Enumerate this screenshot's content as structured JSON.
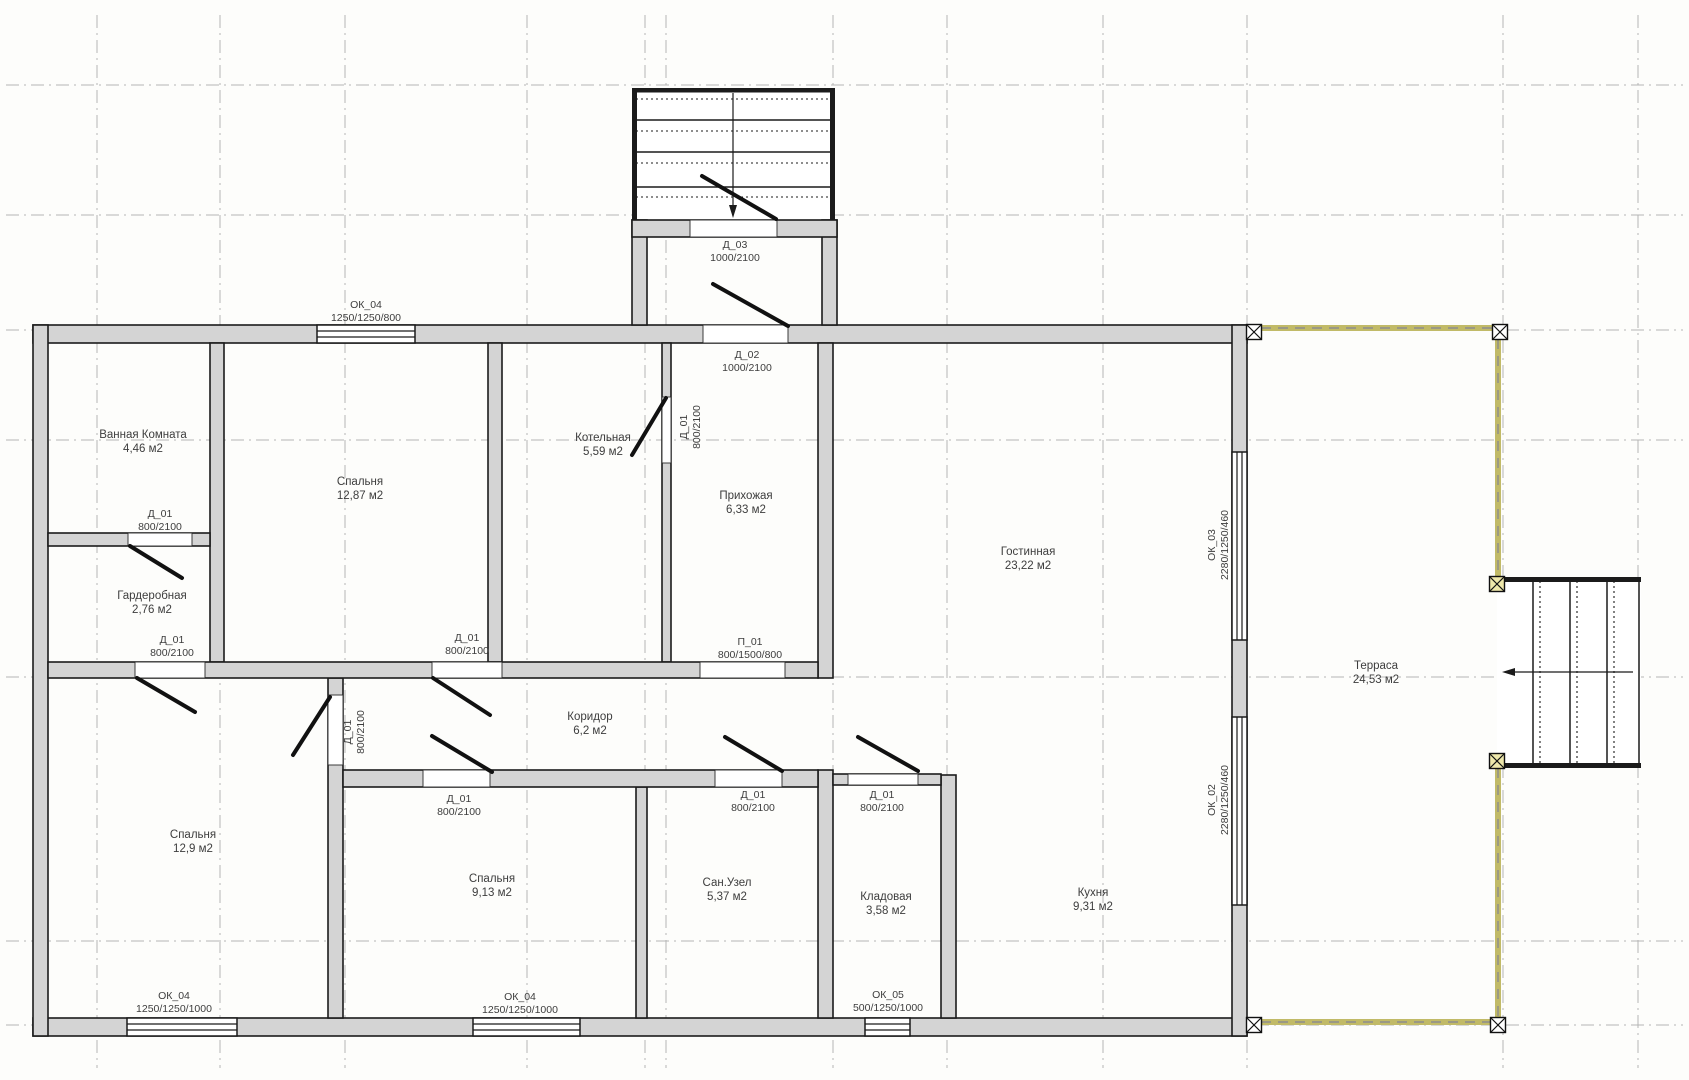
{
  "document": {
    "type": "architectural-floor-plan",
    "units_note": "м2"
  },
  "canvas": {
    "width": 1689,
    "height": 1080,
    "background": "#fdfdfb"
  },
  "colors": {
    "wall_fill": "#d4d4d4",
    "wall_stroke": "#1b1b1b",
    "grid_line": "#b5b5b5",
    "terrace_edge": "#c1ba67",
    "terrace_dash": "#8d8d8d",
    "stair_line": "#1b1b1b",
    "door_leaf": "#111111",
    "label_text": "#3d3d3d",
    "post_fill_corner": "#ffffff",
    "post_fill_stair": "#eee8ab"
  },
  "grid": {
    "vertical_x": [
      97,
      220,
      345,
      527,
      645,
      666,
      833,
      947,
      1103,
      1247,
      1503,
      1638
    ],
    "horizontal_y": [
      85,
      215,
      330,
      440,
      677,
      941,
      1025
    ],
    "x_extent": [
      6,
      1683
    ],
    "y_extent": [
      15,
      1068
    ]
  },
  "walls": [
    [
      33,
      325,
      1214,
      18
    ],
    [
      33,
      1018,
      1214,
      18
    ],
    [
      33,
      325,
      15,
      711
    ],
    [
      1232,
      325,
      15,
      711
    ],
    [
      210,
      343,
      14,
      319
    ],
    [
      488,
      343,
      14,
      319
    ],
    [
      662,
      343,
      9,
      319
    ],
    [
      818,
      343,
      15,
      335
    ],
    [
      328,
      678,
      15,
      340
    ],
    [
      636,
      787,
      11,
      231
    ],
    [
      818,
      770,
      15,
      248
    ],
    [
      941,
      775,
      15,
      243
    ],
    [
      48,
      533,
      162,
      13
    ],
    [
      48,
      662,
      770,
      16
    ],
    [
      343,
      770,
      475,
      17
    ],
    [
      833,
      774,
      108,
      11
    ],
    [
      632,
      220,
      15,
      105
    ],
    [
      822,
      220,
      15,
      105
    ],
    [
      632,
      220,
      205,
      17
    ]
  ],
  "openings": [
    [
      128,
      533,
      64,
      13
    ],
    [
      135,
      662,
      70,
      16
    ],
    [
      432,
      662,
      70,
      16
    ],
    [
      700,
      662,
      85,
      16
    ],
    [
      690,
      220,
      87,
      17
    ],
    [
      703,
      325,
      85,
      18
    ],
    [
      662,
      397,
      9,
      66
    ],
    [
      328,
      695,
      15,
      70
    ],
    [
      423,
      770,
      67,
      17
    ],
    [
      715,
      770,
      67,
      17
    ],
    [
      848,
      774,
      70,
      11
    ]
  ],
  "windows": [
    {
      "x": 317,
      "y": 325,
      "w": 98,
      "h": 18,
      "dir": "h"
    },
    {
      "x": 127,
      "y": 1018,
      "w": 110,
      "h": 18,
      "dir": "h"
    },
    {
      "x": 473,
      "y": 1018,
      "w": 107,
      "h": 18,
      "dir": "h"
    },
    {
      "x": 865,
      "y": 1018,
      "w": 45,
      "h": 18,
      "dir": "h"
    },
    {
      "x": 1232,
      "y": 452,
      "w": 15,
      "h": 188,
      "dir": "v"
    },
    {
      "x": 1232,
      "y": 717,
      "w": 15,
      "h": 188,
      "dir": "v"
    }
  ],
  "door_leaves": [
    [
      130,
      546,
      182,
      578
    ],
    [
      137,
      678,
      195,
      712
    ],
    [
      433,
      678,
      490,
      715
    ],
    [
      666,
      398,
      632,
      455
    ],
    [
      330,
      697,
      293,
      755
    ],
    [
      432,
      736,
      492,
      772
    ],
    [
      725,
      737,
      782,
      771
    ],
    [
      858,
      737,
      918,
      771
    ],
    [
      713,
      284,
      788,
      326
    ],
    [
      702,
      176,
      776,
      219
    ]
  ],
  "terrace": {
    "segments": [
      [
        1261,
        328,
        1493,
        328
      ],
      [
        1261,
        1022,
        1491,
        1022
      ],
      [
        1498,
        339,
        1498,
        577
      ],
      [
        1498,
        768,
        1498,
        1017
      ]
    ],
    "posts": [
      {
        "x": 1254,
        "y": 332,
        "fill": "#ffffff"
      },
      {
        "x": 1500,
        "y": 332,
        "fill": "#ffffff"
      },
      {
        "x": 1254,
        "y": 1025,
        "fill": "#ffffff"
      },
      {
        "x": 1498,
        "y": 1025,
        "fill": "#ffffff"
      },
      {
        "x": 1497,
        "y": 584,
        "fill": "#eee8ab"
      },
      {
        "x": 1497,
        "y": 761,
        "fill": "#eee8ab"
      }
    ]
  },
  "porch_stairs": {
    "x": 632,
    "y": 88,
    "w": 203,
    "h": 132,
    "solid_lines_y": [
      120,
      152,
      187
    ],
    "dotted_lines_y": [
      99,
      131,
      163,
      197
    ],
    "center_x": 733,
    "arrow_tip_y": 218
  },
  "side_stairs": {
    "x": 1497,
    "y": 577,
    "w": 144,
    "h": 191,
    "solid_lines_x": [
      1533,
      1570,
      1607
    ],
    "dotted_lines_x": [
      1540,
      1577,
      1614
    ],
    "arrow_y": 672,
    "arrow_from_x": 1633,
    "arrow_tip_x": 1502
  },
  "room_labels": [
    {
      "name": "Ванная Комната",
      "area": "4,46 м2",
      "x": 143,
      "y": 441
    },
    {
      "name": "Гардеробная",
      "area": "2,76 м2",
      "x": 152,
      "y": 602
    },
    {
      "name": "Спальня",
      "area": "12,87 м2",
      "x": 360,
      "y": 488
    },
    {
      "name": "Котельная",
      "area": "5,59 м2",
      "x": 603,
      "y": 444
    },
    {
      "name": "Прихожая",
      "area": "6,33 м2",
      "x": 746,
      "y": 502
    },
    {
      "name": "Гостинная",
      "area": "23,22 м2",
      "x": 1028,
      "y": 558
    },
    {
      "name": "Спальня",
      "area": "12,9 м2",
      "x": 193,
      "y": 841
    },
    {
      "name": "Коридор",
      "area": "6,2 м2",
      "x": 590,
      "y": 723
    },
    {
      "name": "Спальня",
      "area": "9,13 м2",
      "x": 492,
      "y": 885
    },
    {
      "name": "Сан.Узел",
      "area": "5,37 м2",
      "x": 727,
      "y": 889
    },
    {
      "name": "Кладовая",
      "area": "3,58 м2",
      "x": 886,
      "y": 903
    },
    {
      "name": "Кухня",
      "area": "9,31 м2",
      "x": 1093,
      "y": 899
    },
    {
      "name": "Терраса",
      "area": "24,53 м2",
      "x": 1376,
      "y": 672
    }
  ],
  "tag_labels": [
    {
      "code": "ОК_04",
      "size": "1250/1250/800",
      "x": 366,
      "y": 311,
      "rot": 0
    },
    {
      "code": "Д_03",
      "size": "1000/2100",
      "x": 735,
      "y": 251,
      "rot": 0
    },
    {
      "code": "Д_02",
      "size": "1000/2100",
      "x": 747,
      "y": 361,
      "rot": 0
    },
    {
      "code": "Д_01",
      "size": "800/2100",
      "x": 160,
      "y": 520,
      "rot": 0
    },
    {
      "code": "Д_01",
      "size": "800/2100",
      "x": 172,
      "y": 646,
      "rot": 0
    },
    {
      "code": "Д_01",
      "size": "800/2100",
      "x": 467,
      "y": 644,
      "rot": 0
    },
    {
      "code": "П_01",
      "size": "800/1500/800",
      "x": 750,
      "y": 648,
      "rot": 0
    },
    {
      "code": "Д_01",
      "size": "800/2100",
      "x": 690,
      "y": 427,
      "rot": -90
    },
    {
      "code": "Д_01",
      "size": "800/2100",
      "x": 354,
      "y": 732,
      "rot": -90
    },
    {
      "code": "Д_01",
      "size": "800/2100",
      "x": 459,
      "y": 805,
      "rot": 0
    },
    {
      "code": "Д_01",
      "size": "800/2100",
      "x": 753,
      "y": 801,
      "rot": 0
    },
    {
      "code": "Д_01",
      "size": "800/2100",
      "x": 882,
      "y": 801,
      "rot": 0
    },
    {
      "code": "ОК_04",
      "size": "1250/1250/1000",
      "x": 174,
      "y": 1002,
      "rot": 0
    },
    {
      "code": "ОК_04",
      "size": "1250/1250/1000",
      "x": 520,
      "y": 1003,
      "rot": 0
    },
    {
      "code": "ОК_05",
      "size": "500/1250/1000",
      "x": 888,
      "y": 1001,
      "rot": 0
    },
    {
      "code": "ОК_03",
      "size": "2280/1250/460",
      "x": 1218,
      "y": 545,
      "rot": -90
    },
    {
      "code": "ОК_02",
      "size": "2280/1250/460",
      "x": 1218,
      "y": 800,
      "rot": -90
    }
  ]
}
